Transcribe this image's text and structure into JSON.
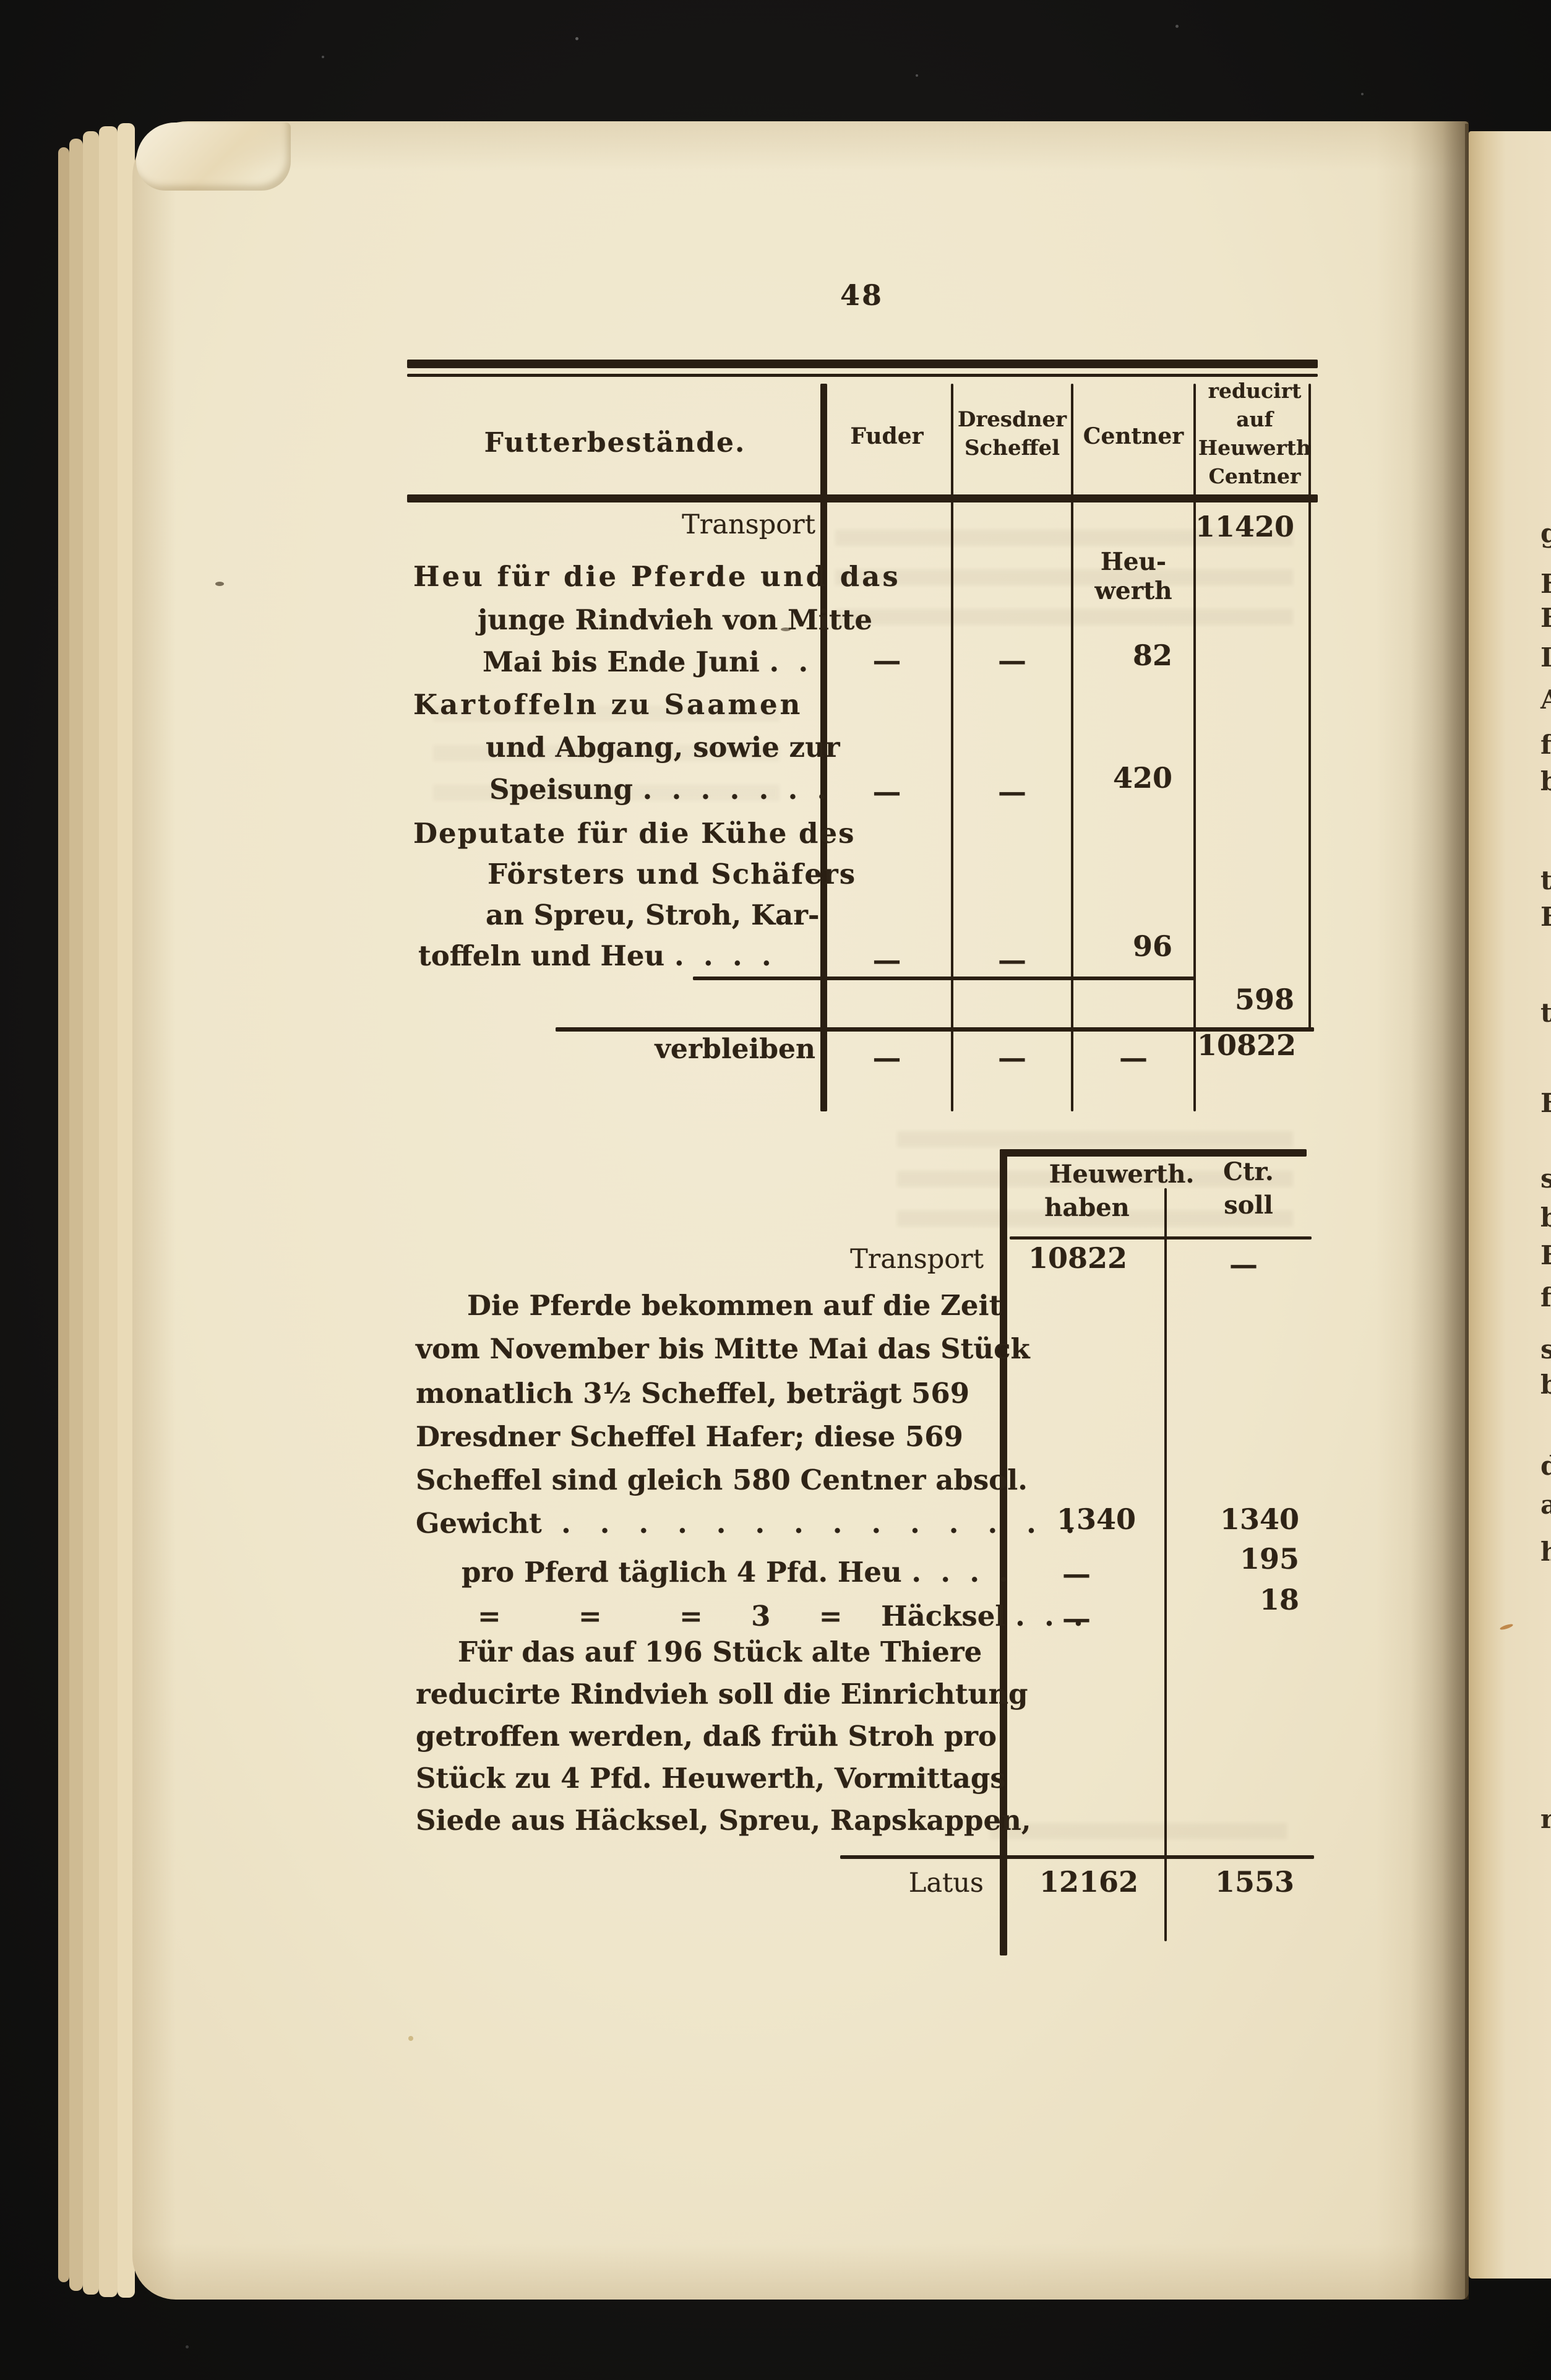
{
  "colors": {
    "background": "#141312",
    "paper": "#efe6cb",
    "paper_edge": "#d9c59c",
    "ink": "#2e2316"
  },
  "page_number": "48",
  "table1": {
    "header": {
      "futter": "Futterbestände.",
      "fuder": "Fuder",
      "dresdner1": "Dresdner",
      "dresdner2": "Scheffel",
      "centner": "Centner",
      "red1": "reducirt",
      "red2": "auf",
      "red3": "Heuwerth",
      "red4": "Centner"
    },
    "transport_label": "Transport",
    "transport_reducirt": "11420",
    "note1": "Heu-",
    "note2": "werth",
    "item1": {
      "l1": "Heu für die Pferde und das",
      "l2": "junge Rindvieh von Mitte",
      "l3": "Mai bis Ende Juni .  .",
      "fuder": "—",
      "scheffel": "—",
      "centner": "82"
    },
    "item2": {
      "l1": "Kartoffeln zu Saamen",
      "l2": "und Abgang, sowie zur",
      "l3": "Speisung .  .  .  .  .  .  .",
      "fuder": "—",
      "scheffel": "—",
      "centner": "420"
    },
    "item3": {
      "l1": "Deputate für die Kühe des",
      "l2": "Försters und Schäfers",
      "l3": "an Spreu, Stroh, Kar-",
      "l4": "toffeln und Heu .  .  .  .",
      "fuder": "—",
      "scheffel": "—",
      "centner": "96"
    },
    "subtotal_reducirt": "598",
    "verbleiben": {
      "label": "verbleiben",
      "fuder": "—",
      "scheffel": "—",
      "centner": "—",
      "reducirt": "10822"
    }
  },
  "table2": {
    "header": {
      "haben1": "Heuwerth.",
      "haben2": "haben",
      "soll1": "Ctr.",
      "soll2": "soll"
    },
    "transport": {
      "label": "Transport",
      "haben": "10822",
      "soll": "—"
    },
    "para1": [
      "Die Pferde bekommen auf die Zeit",
      "vom November bis Mitte Mai das Stück",
      "monatlich 3½ Scheffel, beträgt 569",
      "Dresdner Scheffel Hafer; diese 569",
      "Scheffel sind gleich 580 Centner absol.",
      "Gewicht  .   .   .   .   .   .   .   .   .   .   .   .   .   ."
    ],
    "gewicht": {
      "haben": "1340",
      "soll": "1340"
    },
    "heu": {
      "label": "pro Pferd täglich 4 Pfd. Heu .  .  .  .",
      "haben": "—",
      "soll": "195"
    },
    "haecksel": {
      "label": "=        =        =     3     =    Häcksel .  .  .",
      "haben": "—",
      "soll": "18"
    },
    "para2": [
      "Für das auf 196 Stück alte Thiere",
      "reducirte Rindvieh soll die Einrichtung",
      "getroffen werden, daß früh Stroh pro",
      "Stück zu 4 Pfd. Heuwerth, Vormittags",
      "Siede aus Häcksel, Spreu, Rapskappen,"
    ],
    "latus": {
      "label": "Latus",
      "haben": "12162",
      "soll": "1553"
    }
  },
  "facing_fragments": [
    "g",
    "H",
    "E",
    "I",
    "A",
    "f",
    "b",
    "t",
    "E",
    "t",
    "E",
    "s",
    "b",
    "E",
    "f",
    "s",
    "b",
    "d",
    "a",
    "h",
    "r"
  ]
}
